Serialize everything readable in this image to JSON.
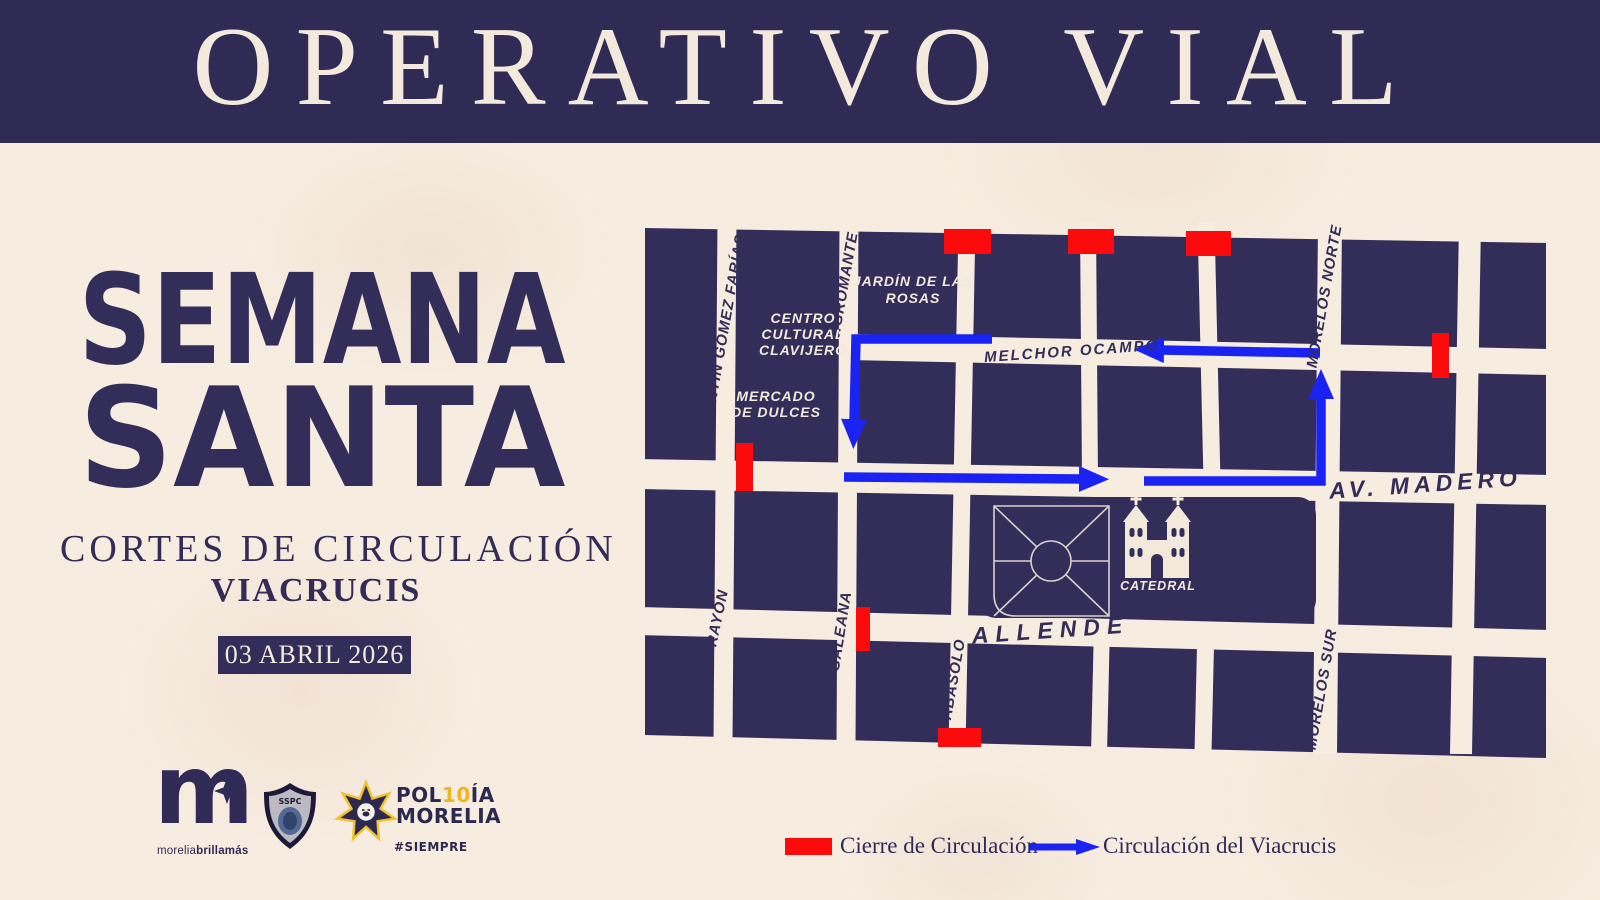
{
  "poster": {
    "header_title": "OPERATIVO VIAL",
    "title_line1": "SEMANA",
    "title_line2": "SANTA",
    "subtitle": "CORTES DE CIRCULACIÓN",
    "event_name": "VIACRUCIS",
    "event_date": "03 ABRIL 2026"
  },
  "map": {
    "street_labels": {
      "valentin_gomez_farias": "VALENTÍN GÓMEZ FARÍAS",
      "nigromante": "NIGROMANTE",
      "morelos_norte": "MORELOS NORTE",
      "melchor_ocampo": "MELCHOR OCAMPO",
      "av_madero": "AV. MADERO",
      "rayon": "RAYÓN",
      "galeana": "GALEANA",
      "abasolo": "ABASOLO",
      "allende": "ALLENDE",
      "morelos_sur": "MORELOS SUR"
    },
    "landmarks": {
      "jardin_line1": "JARDÍN DE LAS",
      "jardin_line2": "ROSAS",
      "centro_line1": "CENTRO",
      "centro_line2": "CULTURAL",
      "centro_line3": "CLAVIJERO",
      "mercado_line1": "MERCADO",
      "mercado_line2": "DE DULCES",
      "catedral": "CATEDRAL"
    }
  },
  "legend": {
    "closure_label": "Cierre de Circulación",
    "route_label": "Circulación del Viacrucis"
  },
  "footer_logos": {
    "morelia_monogram": "m",
    "morelia_tagline_1": "morelia",
    "morelia_tagline_2": "brilla",
    "morelia_tagline_3": "más",
    "sspc_label": "SSPC",
    "policia_prefix": "POL",
    "policia_anniversary": "10",
    "policia_suffix": "ÍA",
    "policia_line2": "MORELIA",
    "hashtag": "#SIEMPRE"
  },
  "colors": {
    "navy": "#302b55",
    "block_navy": "#332e59",
    "cream": "#f6ecdf",
    "cream_text": "#f3e9dc",
    "closure_red": "#fb0b0b",
    "route_blue": "#1b23f2",
    "anniversary_yellow": "#f0b41e"
  }
}
